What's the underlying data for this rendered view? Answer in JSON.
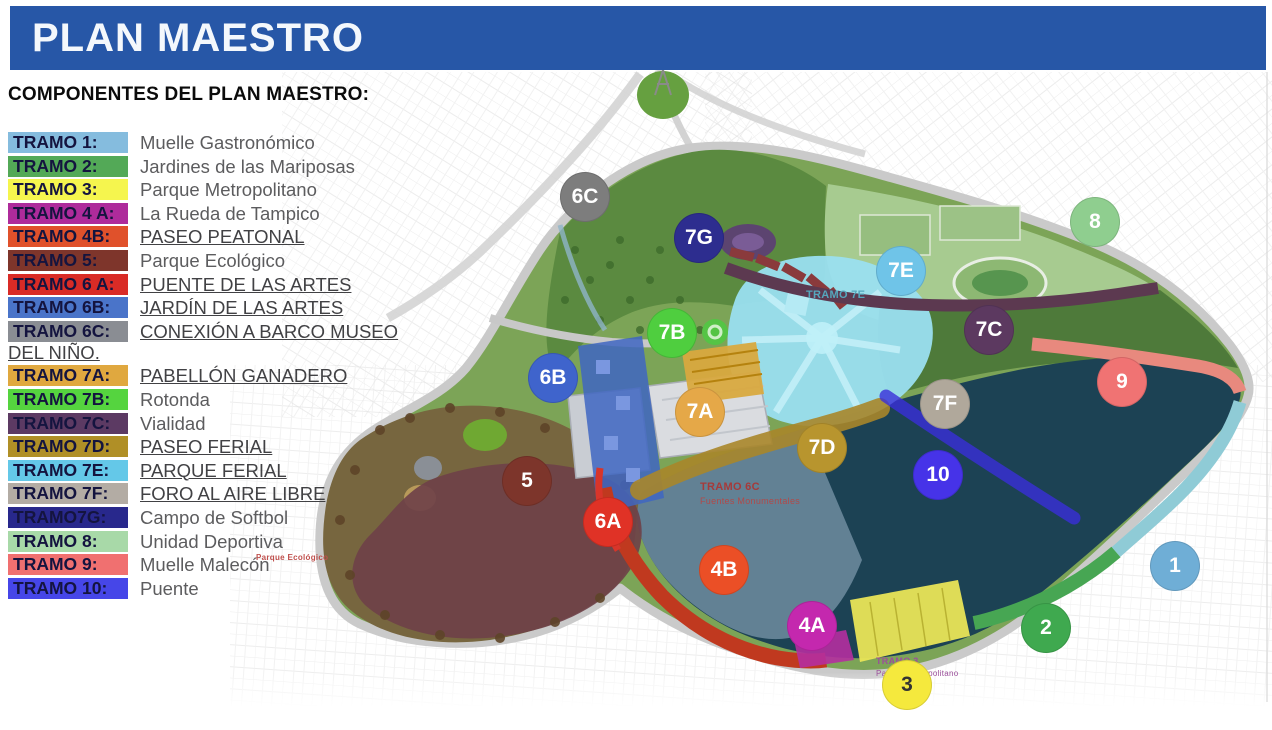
{
  "header": {
    "title": "PLAN MAESTRO",
    "bar_color": "#2757A7"
  },
  "legend": {
    "heading": "COMPONENTES DEL PLAN MAESTRO:",
    "items": [
      {
        "chip": "TRAMO 1:",
        "label": "Muelle Gastronómico",
        "color": "#85BCDE",
        "underline": false
      },
      {
        "chip": "TRAMO 2:",
        "label": "Jardines de las Mariposas",
        "color": "#53A957",
        "underline": false
      },
      {
        "chip": "TRAMO 3:",
        "label": "Parque Metropolitano",
        "color": "#F5F54E",
        "underline": false
      },
      {
        "chip": "TRAMO 4 A:",
        "label": "La Rueda de Tampico",
        "color": "#AE2B9B",
        "underline": false
      },
      {
        "chip": "TRAMO 4B:",
        "label": "PASEO PEATONAL",
        "color": "#E0512B",
        "underline": true
      },
      {
        "chip": "TRAMO 5:",
        "label": "Parque Ecológico",
        "color": "#7E352B",
        "underline": false
      },
      {
        "chip": "TRAMO 6 A:",
        "label": "PUENTE DE LAS ARTES",
        "color": "#D92B26",
        "underline": true
      },
      {
        "chip": "TRAMO 6B:",
        "label": "JARDÍN DE LAS ARTES",
        "color": "#4A74C9",
        "underline": true
      },
      {
        "chip": "TRAMO 6C:",
        "label": "CONEXIÓN A BARCO MUSEO DEL NIÑO.",
        "color": "#8A8D93",
        "underline": true
      },
      {
        "chip": "TRAMO 7A:",
        "label": "PABELLÓN GANADERO",
        "color": "#E0A83F",
        "underline": true
      },
      {
        "chip": "TRAMO 7B:",
        "label": "Rotonda",
        "color": "#55D43F",
        "underline": false
      },
      {
        "chip": "TRAMO 7C:",
        "label": "Vialidad",
        "color": "#5C3A63",
        "underline": false
      },
      {
        "chip": "TRAMO 7D:",
        "label": "PASEO FERIAL",
        "color": "#B08F26",
        "underline": true
      },
      {
        "chip": "TRAMO 7E:",
        "label": "PARQUE FERIAL",
        "color": "#64C8E8",
        "underline": true
      },
      {
        "chip": "TRAMO 7F:",
        "label": "FORO AL AIRE LIBRE",
        "color": "#B3ACA4",
        "underline": true
      },
      {
        "chip": "TRAMO7G:",
        "label": "Campo de Softbol",
        "color": "#28288C",
        "underline": false
      },
      {
        "chip": "TRAMO 8:",
        "label": "Unidad Deportiva",
        "color": "#A8D9A8",
        "underline": false
      },
      {
        "chip": "TRAMO 9:",
        "label": "Muelle Malecón",
        "color": "#F07070",
        "underline": false
      },
      {
        "chip": "TRAMO 10:",
        "label": "Puente",
        "color": "#4646E8",
        "underline": false
      }
    ]
  },
  "map": {
    "markers": [
      {
        "label": "6C",
        "x": 585,
        "y": 197,
        "color": "#7D7D7D",
        "text_color": "#FFFFFF"
      },
      {
        "label": "7G",
        "x": 699,
        "y": 238,
        "color": "#2D2D8F",
        "text_color": "#FFFFFF"
      },
      {
        "label": "8",
        "x": 1095,
        "y": 222,
        "color": "#8FCE8F",
        "text_color": "#FFFFFF"
      },
      {
        "label": "7E",
        "x": 901,
        "y": 271,
        "color": "#6FC4E8",
        "text_color": "#FFFFFF"
      },
      {
        "label": "7B",
        "x": 672,
        "y": 333,
        "color": "#4FCE3F",
        "text_color": "#FFFFFF"
      },
      {
        "label": "7C",
        "x": 989,
        "y": 330,
        "color": "#5C3960",
        "text_color": "#FFFFFF"
      },
      {
        "label": "6B",
        "x": 553,
        "y": 378,
        "color": "#3F64CC",
        "text_color": "#FFFFFF"
      },
      {
        "label": "9",
        "x": 1122,
        "y": 382,
        "color": "#F07373",
        "text_color": "#FFFFFF"
      },
      {
        "label": "7F",
        "x": 945,
        "y": 404,
        "color": "#B0A89B",
        "text_color": "#FFFFFF"
      },
      {
        "label": "7A",
        "x": 700,
        "y": 412,
        "color": "#E5A848",
        "text_color": "#FFFFFF"
      },
      {
        "label": "7D",
        "x": 822,
        "y": 448,
        "color": "#B8952E",
        "text_color": "#FFFFFF"
      },
      {
        "label": "10",
        "x": 938,
        "y": 475,
        "color": "#4633E8",
        "text_color": "#FFFFFF"
      },
      {
        "label": "5",
        "x": 527,
        "y": 481,
        "color": "#7D352B",
        "text_color": "#FFFFFF"
      },
      {
        "label": "6A",
        "x": 608,
        "y": 522,
        "color": "#E03226",
        "text_color": "#FFFFFF"
      },
      {
        "label": "4B",
        "x": 724,
        "y": 570,
        "color": "#EB4F26",
        "text_color": "#FFFFFF"
      },
      {
        "label": "1",
        "x": 1175,
        "y": 566,
        "color": "#6FAED6",
        "text_color": "#FFFFFF"
      },
      {
        "label": "4A",
        "x": 812,
        "y": 626,
        "color": "#C428AE",
        "text_color": "#FFFFFF"
      },
      {
        "label": "2",
        "x": 1046,
        "y": 628,
        "color": "#3FA94F",
        "text_color": "#FFFFFF"
      },
      {
        "label": "3",
        "x": 907,
        "y": 685,
        "color": "#F5E93D",
        "text_color": "#333333"
      }
    ],
    "annotations": [
      {
        "text": "TRAMO 6C",
        "x": 700,
        "y": 481,
        "color": "#A63A3A",
        "size": 11,
        "bold": true
      },
      {
        "text": "Fuentes Monumentales",
        "x": 700,
        "y": 496,
        "color": "#B04A4A",
        "size": 9,
        "bold": false
      },
      {
        "text": "TRAMO 7E",
        "x": 806,
        "y": 289,
        "color": "#55A7BD",
        "size": 11,
        "bold": true
      },
      {
        "text": "TRAMO 3",
        "x": 876,
        "y": 656,
        "color": "#9B4F9B",
        "size": 9,
        "bold": true
      },
      {
        "text": "Parque Metropolitano",
        "x": 876,
        "y": 669,
        "color": "#9B4F9B",
        "size": 8,
        "bold": false
      },
      {
        "text": "Parque Ecológico",
        "x": 256,
        "y": 553,
        "color": "#C0504D",
        "size": 8,
        "bold": true
      }
    ]
  }
}
